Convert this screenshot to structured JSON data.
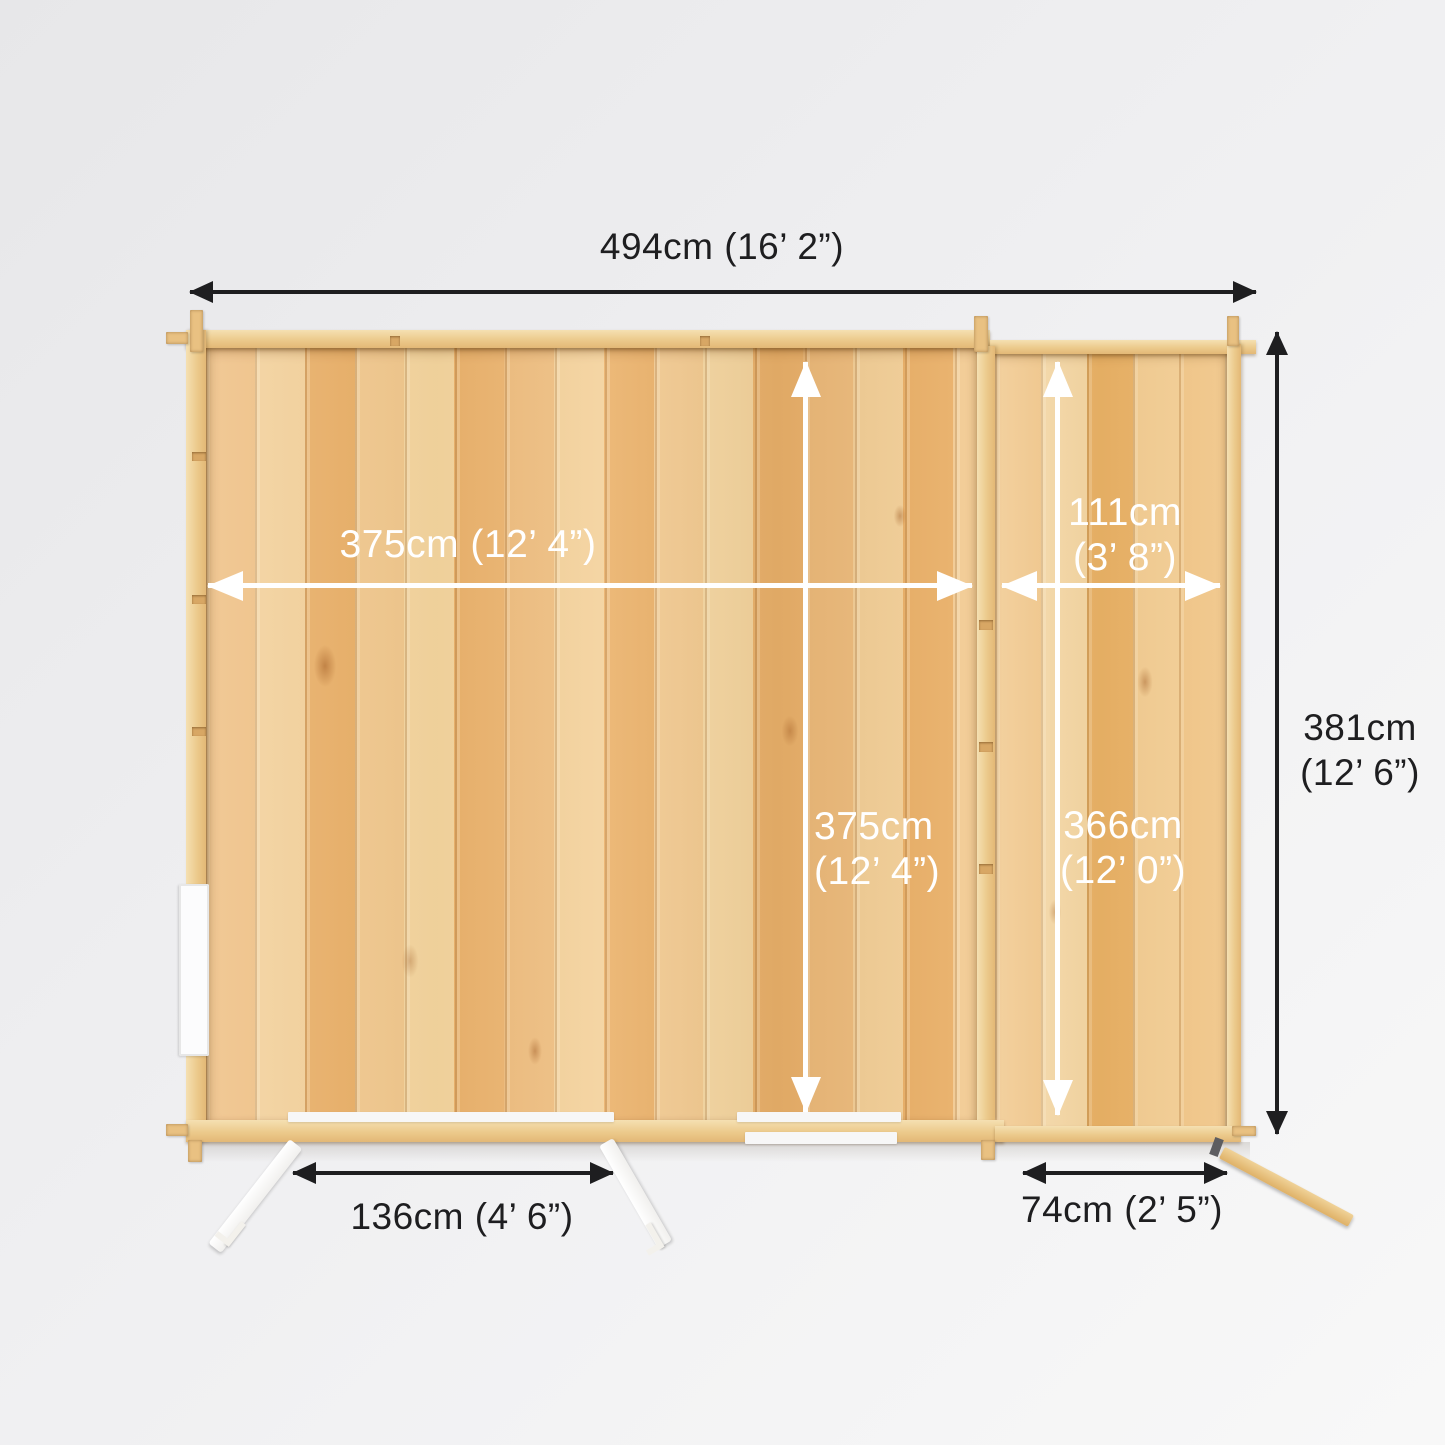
{
  "diagram": {
    "subject": "log cabin with side annex - top-down floor plan with dimensions",
    "dimensions": {
      "overall_width": "494cm (16’ 2”)",
      "overall_depth": {
        "line1": "381cm",
        "line2": "(12’ 6”)"
      },
      "main_internal_width": "375cm (12’ 4”)",
      "main_internal_depth": {
        "line1": "375cm",
        "line2": "(12’ 4”)"
      },
      "annex_internal_width": {
        "line1": "111cm",
        "line2": "(3’ 8”)"
      },
      "annex_internal_depth": {
        "line1": "366cm",
        "line2": "(12’ 0”)"
      },
      "main_door_width": "136cm (4’ 6”)",
      "annex_door_width": "74cm (2’ 5”)"
    }
  },
  "colors": {
    "background": "#efeff1",
    "wood_mid": "#edbd7a",
    "wood_rail_hi": "#f5e0b2",
    "wood_rail_lo": "#e3b876",
    "label_dark": "#1e1e20",
    "label_light": "#ffffff"
  }
}
